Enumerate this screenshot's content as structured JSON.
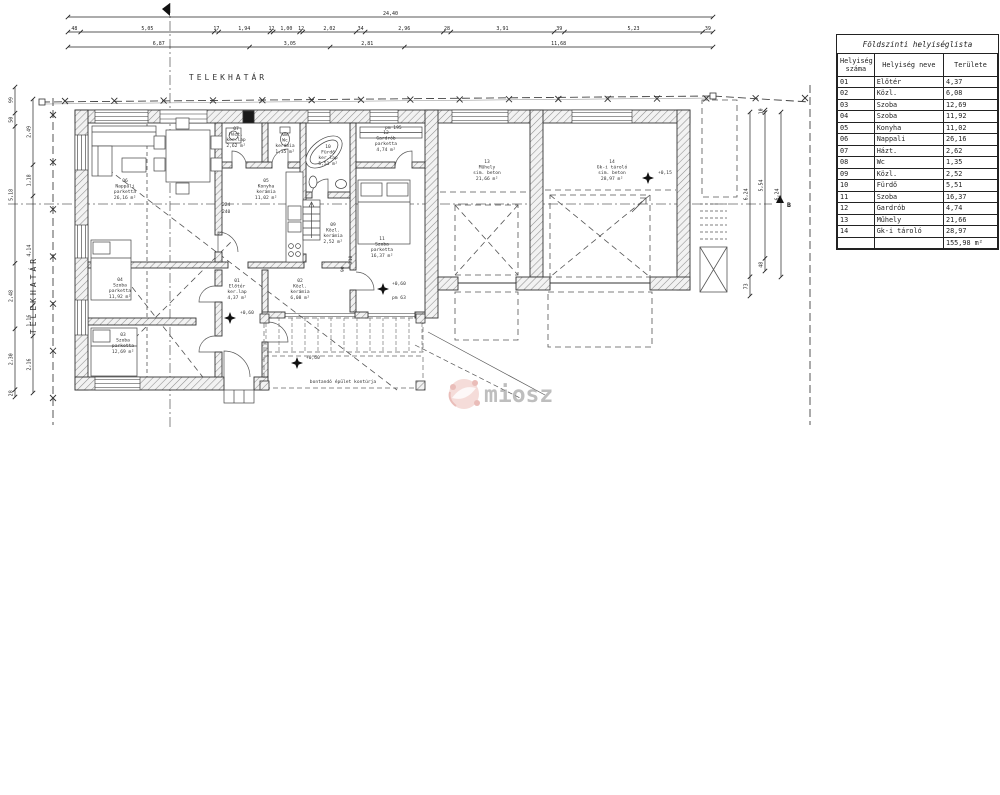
{
  "boundary": {
    "label": "TELEKHATÁR"
  },
  "dims": {
    "top_total": [
      "24,40"
    ],
    "top_row2": [
      "48",
      "5,05",
      "17",
      "1,94",
      "12",
      "1,00",
      "12",
      "2,02",
      "34",
      "2,96",
      "28",
      "3,91",
      "39",
      "5,23",
      "39"
    ],
    "top_row3": [
      "6,87",
      "3,05",
      "2,81",
      "11,68"
    ],
    "left_outer": [
      "99",
      "50",
      "5,18",
      "2,48",
      "2,30",
      "28"
    ],
    "left_inner": [
      "2,49",
      "1,18",
      "4,14",
      "1,16",
      "2,16"
    ],
    "right_1": [
      "6,24",
      "73"
    ],
    "right_2": [
      "10",
      "5,54",
      "48"
    ],
    "right_3": [
      "6,24"
    ],
    "interior": {
      "d224": "224",
      "d240": "240",
      "pm195": "pm 195",
      "pm63": "pm 63",
      "d90": "90",
      "d210": "210"
    }
  },
  "rooms": [
    {
      "num": "01",
      "name": "Előtér",
      "floor": "ker.lap",
      "area": "4,37 m²",
      "x": 237,
      "y": 282
    },
    {
      "num": "02",
      "name": "Közl.",
      "floor": "kerámia",
      "area": "6,08 m²",
      "x": 300,
      "y": 282
    },
    {
      "num": "03",
      "name": "Szoba",
      "floor": "parketta",
      "area": "12,69 m²",
      "x": 123,
      "y": 336
    },
    {
      "num": "04",
      "name": "Szoba",
      "floor": "parketta",
      "area": "11,92 m²",
      "x": 120,
      "y": 281
    },
    {
      "num": "05",
      "name": "Konyha",
      "floor": "kerámia",
      "area": "11,02 m²",
      "x": 266,
      "y": 182
    },
    {
      "num": "06",
      "name": "Nappali",
      "floor": "parketta",
      "area": "26,16 m²",
      "x": 125,
      "y": 182
    },
    {
      "num": "07",
      "name": "Házt.",
      "floor": "ker.lap",
      "area": "2,62 m²",
      "x": 236,
      "y": 130
    },
    {
      "num": "08",
      "name": "Wc",
      "floor": "kerámia",
      "area": "1,35 m²",
      "x": 285,
      "y": 136
    },
    {
      "num": "09",
      "name": "Közl.",
      "floor": "kerámia",
      "area": "2,52 m²",
      "x": 333,
      "y": 226
    },
    {
      "num": "10",
      "name": "Fürdő",
      "floor": "ker.lap",
      "area": "5,51 m²",
      "x": 328,
      "y": 148
    },
    {
      "num": "11",
      "name": "Szoba",
      "floor": "parketta",
      "area": "16,37 m²",
      "x": 382,
      "y": 240
    },
    {
      "num": "12",
      "name": "Gardrób",
      "floor": "parketta",
      "area": "4,74 m²",
      "x": 386,
      "y": 134
    },
    {
      "num": "13",
      "name": "Műhely",
      "floor": "sim. beton",
      "area": "21,66 m²",
      "x": 487,
      "y": 163
    },
    {
      "num": "14",
      "name": "Gk-i tároló",
      "floor": "sim. beton",
      "area": "28,97 m²",
      "x": 612,
      "y": 163
    }
  ],
  "table": {
    "title": "Földszinti helyiséglista",
    "headers": [
      "Helyiség száma",
      "Helyiség neve",
      "Területe"
    ],
    "rows": [
      [
        "01",
        "Előtér",
        "4,37"
      ],
      [
        "02",
        "Közl.",
        "6,08"
      ],
      [
        "03",
        "Szoba",
        "12,69"
      ],
      [
        "04",
        "Szoba",
        "11,92"
      ],
      [
        "05",
        "Konyha",
        "11,02"
      ],
      [
        "06",
        "Nappali",
        "26,16"
      ],
      [
        "07",
        "Házt.",
        "2,62"
      ],
      [
        "08",
        "Wc",
        "1,35"
      ],
      [
        "09",
        "Közl.",
        "2,52"
      ],
      [
        "10",
        "Fürdő",
        "5,51"
      ],
      [
        "11",
        "Szoba",
        "16,37"
      ],
      [
        "12",
        "Gardrób",
        "4,74"
      ],
      [
        "13",
        "Műhely",
        "21,66"
      ],
      [
        "14",
        "Gk-i tároló",
        "28,97"
      ]
    ],
    "total": "155,98 m²"
  },
  "annotations": {
    "demolish_note": "bontandó épület kontúrja",
    "elev_house": "+0,60",
    "elev_garage": "+0,15",
    "section_b": "B"
  },
  "watermark": {
    "text": "miosz",
    "logo_color": "#cf6a5f",
    "text_color": "#9a9a9a"
  }
}
